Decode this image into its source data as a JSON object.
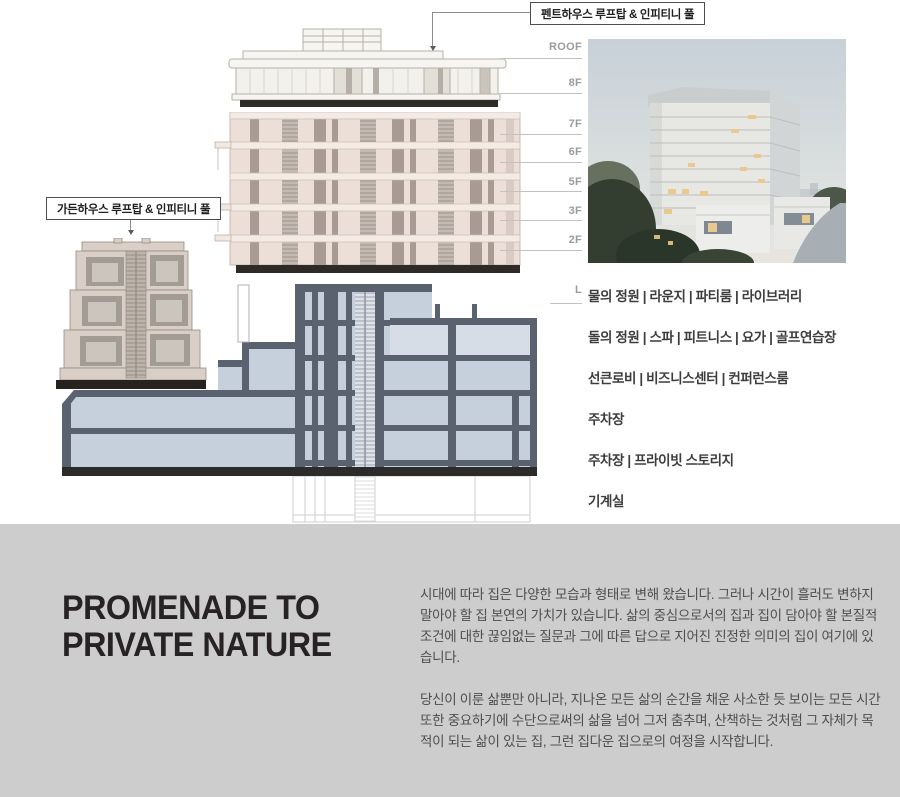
{
  "colors": {
    "page_bg": "#ffffff",
    "intro_band_bg": "#cdcdcd",
    "heading_text": "#272325",
    "body_text": "#4e4e4e",
    "floor_label": "#9b9b9b",
    "section_wall": "#5a6270",
    "section_room": "#c6d0dd",
    "facade_beige": "#ecdfd8",
    "facade_strip": "#a99b94",
    "base_band": "#2b2b29"
  },
  "diagram": {
    "callouts": {
      "penthouse": "펜트하우스 루프탑 & 인피티니 풀",
      "garden": "가든하우스 루프탑 & 인피티니 풀"
    },
    "floors": [
      {
        "label": "ROOF"
      },
      {
        "label": "8F"
      },
      {
        "label": "7F"
      },
      {
        "label": "6F"
      },
      {
        "label": "5F"
      },
      {
        "label": "3F"
      },
      {
        "label": "2F"
      },
      {
        "label": "L"
      }
    ],
    "amenities": [
      "물의 정원 | 라운지 | 파티룸 | 라이브러리",
      "돌의 정원 | 스파 | 피트니스 | 요가 | 골프연습장",
      "선큰로비 | 비즈니스센터 | 컨퍼런스룸",
      "주차장",
      "주차장 | 프라이빗 스토리지",
      "기계실"
    ]
  },
  "intro": {
    "title_line1": "PROMENADE TO",
    "title_line2": "PRIVATE NATURE",
    "paragraph1": "시대에 따라 집은 다양한 모습과 형태로 변해 왔습니다. 그러나 시간이 흘러도 변하지 말아야 할 집 본연의 가치가 있습니다. 삶의 중심으로서의 집과 집이 담아야 할 본질적 조건에 대한 끊임없는 질문과 그에 따른 답으로 지어진 진정한 의미의 집이 여기에 있습니다.",
    "paragraph2": "당신이 이룬 삶뿐만 아니라, 지나온 모든 삶의 순간을 채운 사소한 듯 보이는 모든 시간 또한 중요하기에 수단으로써의 삶을 넘어 그저 춤추며, 산책하는 것처럼 그 자체가 목적이 되는 삶이 있는 집, 그런 집다운 집으로의 여정을 시작합니다."
  }
}
